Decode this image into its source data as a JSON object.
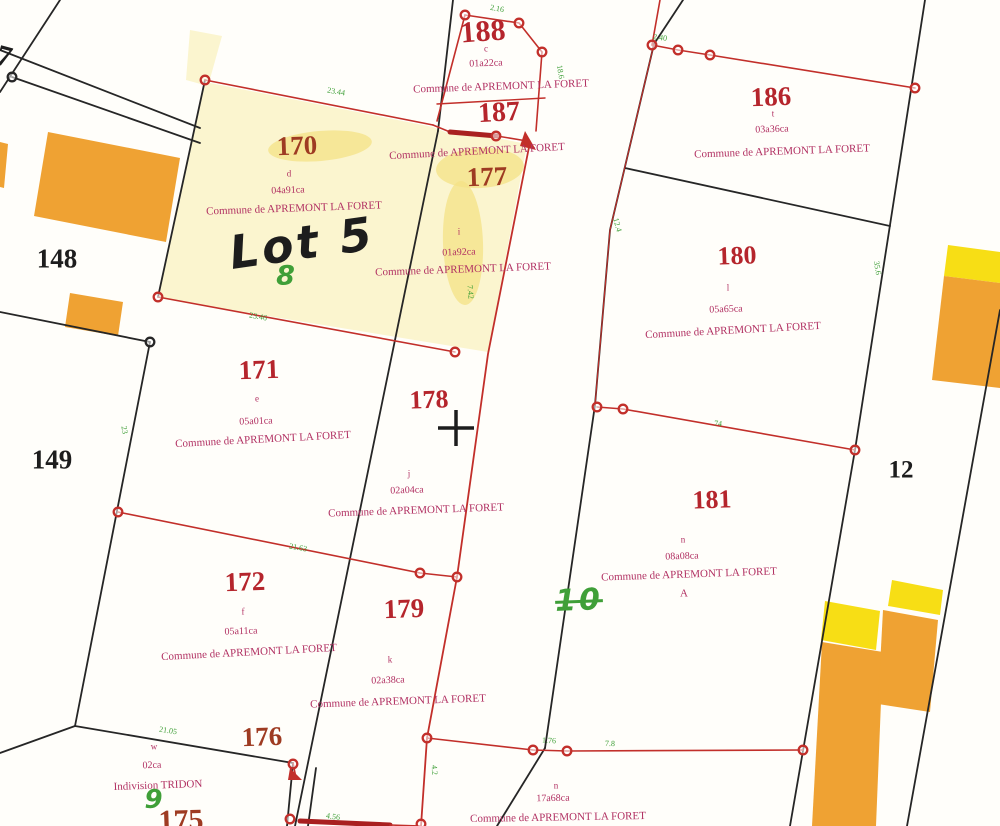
{
  "map": {
    "title": "Plan cadastral - Commune de APREMONT LA FORET",
    "commune_label": "Commune de APREMONT LA FORET",
    "colors": {
      "black": "#1d1d1d",
      "line_black": "#262626",
      "line_red": "#c22f2a",
      "thick_red": "#a92020",
      "red": "#b5252c",
      "red2": "#9e3b22",
      "magenta": "#b13062",
      "green": "#3f9f38",
      "cream": "#fbf5cf",
      "blob": "#f4e286",
      "orange": "#efa233",
      "yellow": "#f7de15",
      "white": "#ffffff"
    },
    "highlights": [
      {
        "name": "parcel-170-177-highlight",
        "points": "205,82 433,127 450,134 497,138 527,144 488,352 158,298",
        "fill": "cream"
      },
      {
        "name": "corner-highlight",
        "points": "190,30 222,36 208,86 186,80",
        "fill": "cream"
      }
    ],
    "blobs": [
      {
        "name": "highlight-blob",
        "cx": 320,
        "cy": 146,
        "rx": 52,
        "ry": 15,
        "rot": -5
      },
      {
        "name": "highlight-blob",
        "cx": 480,
        "cy": 168,
        "rx": 44,
        "ry": 20,
        "rot": -3
      },
      {
        "name": "highlight-blob",
        "cx": 463,
        "cy": 243,
        "rx": 20,
        "ry": 62,
        "rot": -2
      }
    ],
    "buildings": [
      {
        "name": "building-orange",
        "points": "48,132 180,158 166,242 34,216",
        "fill": "orange"
      },
      {
        "name": "building-orange",
        "points": "70,293 123,302 118,336 65,327",
        "fill": "orange"
      },
      {
        "name": "building-orange",
        "points": "0,142 8,144 4,188 0,187",
        "fill": "orange"
      },
      {
        "name": "building-yellow",
        "points": "948,245 1000,252 1000,283 944,276",
        "fill": "yellow"
      },
      {
        "name": "building-orange",
        "points": "944,276 1000,283 1000,388 932,380",
        "fill": "orange"
      },
      {
        "name": "building-yellow",
        "points": "825,601 880,611 876,650 821,640",
        "fill": "yellow"
      },
      {
        "name": "building-yellow",
        "points": "892,580 943,590 940,615 888,606",
        "fill": "yellow"
      },
      {
        "name": "building-orange",
        "points": "822,642 883,652 876,826 812,826",
        "fill": "orange"
      },
      {
        "name": "building-orange",
        "points": "883,610 938,620 930,712 878,704",
        "fill": "orange"
      }
    ],
    "black_lines": [
      {
        "p": "0,92 60,0"
      },
      {
        "p": "0,50 200,128"
      },
      {
        "p": "12,77 200,143"
      },
      {
        "p": "205,80 158,297"
      },
      {
        "p": "0,312 150,342"
      },
      {
        "p": "150,342 75,726"
      },
      {
        "p": "0,753 75,726"
      },
      {
        "p": "75,726 293,763"
      },
      {
        "p": "293,763 287,826"
      },
      {
        "p": "316,768 308,826"
      },
      {
        "p": "453,0 438,131"
      },
      {
        "p": "438,131 295,826"
      },
      {
        "p": "683,0 654,44"
      },
      {
        "p": "654,44 610,230 595,405"
      },
      {
        "p": "595,405 545,748"
      },
      {
        "p": "545,748 497,826"
      },
      {
        "p": "925,0 855,450"
      },
      {
        "p": "855,450 790,826"
      },
      {
        "p": "1000,310 907,826"
      },
      {
        "p": "625,168 890,226"
      }
    ],
    "red_lines": [
      {
        "p": "205,80 433,125",
        "w": 1.6
      },
      {
        "p": "433,125 450,132",
        "w": 1.6
      },
      {
        "p": "450,132 497,136",
        "w": 5
      },
      {
        "p": "497,136 527,141",
        "w": 1.6
      },
      {
        "p": "465,15 519,23 542,52",
        "w": 1.6
      },
      {
        "p": "542,52 536,131",
        "w": 1.6
      },
      {
        "p": "465,15 437,121",
        "w": 1.6
      },
      {
        "p": "437,104 545,98",
        "w": 1.4
      },
      {
        "p": "530,142 488,354 457,577 427,738 421,826",
        "w": 1.8
      },
      {
        "p": "158,297 455,352",
        "w": 1.6
      },
      {
        "p": "118,512 420,573 457,577",
        "w": 1.6
      },
      {
        "p": "597,407 623,409 855,450",
        "w": 1.6
      },
      {
        "p": "427,738 533,750 567,751 803,750",
        "w": 1.6
      },
      {
        "p": "652,45 660,0",
        "w": 1.6
      },
      {
        "p": "652,45 678,50 710,55 915,88",
        "w": 1.6
      },
      {
        "p": "654,44 610,230 595,405",
        "w": 1.1
      },
      {
        "p": "300,821 390,825",
        "w": 5
      },
      {
        "p": "390,825 421,826",
        "w": 1.6
      },
      {
        "p": "293,763 296,778",
        "w": 1.6
      }
    ],
    "vertices": [
      {
        "x": 205,
        "y": 80,
        "c": "red"
      },
      {
        "x": 158,
        "y": 297,
        "c": "red"
      },
      {
        "x": 455,
        "y": 352,
        "c": "red"
      },
      {
        "x": 465,
        "y": 15,
        "c": "red"
      },
      {
        "x": 519,
        "y": 23,
        "c": "red"
      },
      {
        "x": 542,
        "y": 52,
        "c": "red"
      },
      {
        "x": 496,
        "y": 136,
        "c": "red"
      },
      {
        "x": 652,
        "y": 45,
        "c": "red"
      },
      {
        "x": 678,
        "y": 50,
        "c": "red"
      },
      {
        "x": 710,
        "y": 55,
        "c": "red"
      },
      {
        "x": 915,
        "y": 88,
        "c": "red"
      },
      {
        "x": 597,
        "y": 407,
        "c": "red"
      },
      {
        "x": 623,
        "y": 409,
        "c": "red"
      },
      {
        "x": 855,
        "y": 450,
        "c": "red"
      },
      {
        "x": 118,
        "y": 512,
        "c": "red"
      },
      {
        "x": 420,
        "y": 573,
        "c": "red"
      },
      {
        "x": 457,
        "y": 577,
        "c": "red"
      },
      {
        "x": 427,
        "y": 738,
        "c": "red"
      },
      {
        "x": 533,
        "y": 750,
        "c": "red"
      },
      {
        "x": 567,
        "y": 751,
        "c": "red"
      },
      {
        "x": 803,
        "y": 750,
        "c": "red"
      },
      {
        "x": 290,
        "y": 819,
        "c": "red"
      },
      {
        "x": 421,
        "y": 824,
        "c": "red"
      },
      {
        "x": 293,
        "y": 764,
        "c": "red"
      },
      {
        "x": 12,
        "y": 77,
        "c": "black"
      },
      {
        "x": 150,
        "y": 342,
        "c": "black"
      }
    ],
    "spikes": [
      {
        "points": "525,131 536,150 520,146"
      },
      {
        "points": "290,768 302,780 288,780"
      }
    ],
    "cross": {
      "x": 456,
      "y": 428,
      "len": 18,
      "w": 3.5
    }
  },
  "labels": [
    {
      "text": "7",
      "x": 4,
      "y": 57,
      "s": 30,
      "c": "black",
      "r": 15,
      "name": "parcel-number-7"
    },
    {
      "text": "148",
      "x": 57,
      "y": 259,
      "s": 27,
      "c": "black",
      "r": 0,
      "name": "parcel-number-148"
    },
    {
      "text": "149",
      "x": 52,
      "y": 460,
      "s": 27,
      "c": "black",
      "r": 0,
      "name": "parcel-number-149"
    },
    {
      "text": "12",
      "x": 901,
      "y": 470,
      "s": 25,
      "c": "black",
      "r": 0,
      "name": "parcel-number-12"
    },
    {
      "text": "188",
      "x": 483,
      "y": 32,
      "s": 30,
      "c": "red",
      "r": -4,
      "name": "parcel-number-188"
    },
    {
      "text": "c",
      "x": 486,
      "y": 49,
      "s": 9,
      "c": "magenta",
      "r": 0,
      "name": "letter-label"
    },
    {
      "text": "01a22ca",
      "x": 486,
      "y": 64,
      "s": 10,
      "c": "magenta",
      "r": -2,
      "name": "area-label"
    },
    {
      "text": "Commune de APREMONT LA FORET",
      "x": 501,
      "y": 87,
      "s": 11,
      "c": "magenta",
      "r": -2,
      "name": "commune-label"
    },
    {
      "text": "187",
      "x": 499,
      "y": 113,
      "s": 28,
      "c": "red",
      "r": -3,
      "name": "parcel-number-187"
    },
    {
      "text": "Commune de APREMONT LA FORET",
      "x": 477,
      "y": 152,
      "s": 11,
      "c": "magenta",
      "r": -3,
      "name": "commune-label"
    },
    {
      "text": "177",
      "x": 487,
      "y": 177,
      "s": 27,
      "c": "red2",
      "r": -2,
      "name": "parcel-number-177"
    },
    {
      "text": "i",
      "x": 459,
      "y": 232,
      "s": 9,
      "c": "magenta",
      "r": 0,
      "name": "letter-label"
    },
    {
      "text": "01a92ca",
      "x": 459,
      "y": 253,
      "s": 10,
      "c": "magenta",
      "r": -2,
      "name": "area-label"
    },
    {
      "text": "Commune de APREMONT LA FORET",
      "x": 463,
      "y": 270,
      "s": 11,
      "c": "magenta",
      "r": -2,
      "name": "commune-label"
    },
    {
      "text": "186",
      "x": 771,
      "y": 97,
      "s": 27,
      "c": "red",
      "r": -2,
      "name": "parcel-number-186"
    },
    {
      "text": "t",
      "x": 773,
      "y": 114,
      "s": 9,
      "c": "magenta",
      "r": 0,
      "name": "letter-label"
    },
    {
      "text": "03a36ca",
      "x": 772,
      "y": 130,
      "s": 10,
      "c": "magenta",
      "r": -2,
      "name": "area-label"
    },
    {
      "text": "Commune de APREMONT LA FORET",
      "x": 782,
      "y": 152,
      "s": 11,
      "c": "magenta",
      "r": -2,
      "name": "commune-label"
    },
    {
      "text": "170",
      "x": 297,
      "y": 146,
      "s": 27,
      "c": "red2",
      "r": -2,
      "name": "parcel-number-170"
    },
    {
      "text": "d",
      "x": 289,
      "y": 174,
      "s": 9,
      "c": "magenta",
      "r": 0,
      "name": "letter-label"
    },
    {
      "text": "04a91ca",
      "x": 288,
      "y": 191,
      "s": 10,
      "c": "magenta",
      "r": -2,
      "name": "area-label"
    },
    {
      "text": "Commune de APREMONT LA FORET",
      "x": 294,
      "y": 209,
      "s": 11,
      "c": "magenta",
      "r": -2,
      "name": "commune-label"
    },
    {
      "text": "Lot 5",
      "x": 302,
      "y": 243,
      "s": 46,
      "c": "black",
      "r": -8,
      "name": "lot-annotation",
      "hand": true
    },
    {
      "text": "8",
      "x": 287,
      "y": 276,
      "s": 27,
      "c": "green",
      "r": 0,
      "name": "green-annotation-8",
      "hand": true
    },
    {
      "text": "180",
      "x": 737,
      "y": 256,
      "s": 26,
      "c": "red",
      "r": -2,
      "name": "parcel-number-180"
    },
    {
      "text": "l",
      "x": 728,
      "y": 288,
      "s": 9,
      "c": "magenta",
      "r": 0,
      "name": "letter-label"
    },
    {
      "text": "05a65ca",
      "x": 726,
      "y": 310,
      "s": 10,
      "c": "magenta",
      "r": -2,
      "name": "area-label"
    },
    {
      "text": "Commune de APREMONT LA FORET",
      "x": 733,
      "y": 331,
      "s": 11,
      "c": "magenta",
      "r": -3,
      "name": "commune-label"
    },
    {
      "text": "171",
      "x": 259,
      "y": 370,
      "s": 27,
      "c": "red",
      "r": -2,
      "name": "parcel-number-171"
    },
    {
      "text": "e",
      "x": 257,
      "y": 399,
      "s": 9,
      "c": "magenta",
      "r": 0,
      "name": "letter-label"
    },
    {
      "text": "05a01ca",
      "x": 256,
      "y": 422,
      "s": 10,
      "c": "magenta",
      "r": -2,
      "name": "area-label"
    },
    {
      "text": "Commune de APREMONT LA FORET",
      "x": 263,
      "y": 440,
      "s": 11,
      "c": "magenta",
      "r": -3,
      "name": "commune-label"
    },
    {
      "text": "178",
      "x": 429,
      "y": 400,
      "s": 26,
      "c": "red",
      "r": -2,
      "name": "parcel-number-178"
    },
    {
      "text": "j",
      "x": 409,
      "y": 474,
      "s": 9,
      "c": "magenta",
      "r": 0,
      "name": "letter-label"
    },
    {
      "text": "02a04ca",
      "x": 407,
      "y": 491,
      "s": 10,
      "c": "magenta",
      "r": -2,
      "name": "area-label"
    },
    {
      "text": "Commune de APREMONT LA FORET",
      "x": 416,
      "y": 511,
      "s": 11,
      "c": "magenta",
      "r": -2,
      "name": "commune-label"
    },
    {
      "text": "181",
      "x": 712,
      "y": 500,
      "s": 26,
      "c": "red",
      "r": -2,
      "name": "parcel-number-181"
    },
    {
      "text": "n",
      "x": 683,
      "y": 540,
      "s": 9,
      "c": "magenta",
      "r": 0,
      "name": "letter-label"
    },
    {
      "text": "08a08ca",
      "x": 682,
      "y": 557,
      "s": 10,
      "c": "magenta",
      "r": -2,
      "name": "area-label"
    },
    {
      "text": "Commune de APREMONT LA FORET",
      "x": 689,
      "y": 575,
      "s": 11,
      "c": "magenta",
      "r": -2,
      "name": "commune-label"
    },
    {
      "text": "A",
      "x": 684,
      "y": 594,
      "s": 11,
      "c": "magenta",
      "r": 0,
      "name": "letter-label"
    },
    {
      "text": "10",
      "x": 579,
      "y": 601,
      "s": 30,
      "c": "green",
      "r": -2,
      "name": "green-annotation-10",
      "hand": true,
      "strike": true
    },
    {
      "text": "172",
      "x": 245,
      "y": 582,
      "s": 27,
      "c": "red",
      "r": -2,
      "name": "parcel-number-172"
    },
    {
      "text": "f",
      "x": 243,
      "y": 612,
      "s": 9,
      "c": "magenta",
      "r": 0,
      "name": "letter-label"
    },
    {
      "text": "05a11ca",
      "x": 241,
      "y": 632,
      "s": 10,
      "c": "magenta",
      "r": -2,
      "name": "area-label"
    },
    {
      "text": "Commune de APREMONT LA FORET",
      "x": 249,
      "y": 653,
      "s": 11,
      "c": "magenta",
      "r": -3,
      "name": "commune-label"
    },
    {
      "text": "179",
      "x": 404,
      "y": 609,
      "s": 27,
      "c": "red",
      "r": -2,
      "name": "parcel-number-179"
    },
    {
      "text": "k",
      "x": 390,
      "y": 660,
      "s": 9,
      "c": "magenta",
      "r": 0,
      "name": "letter-label"
    },
    {
      "text": "02a38ca",
      "x": 388,
      "y": 681,
      "s": 10,
      "c": "magenta",
      "r": -2,
      "name": "area-label"
    },
    {
      "text": "Commune de APREMONT LA FORET",
      "x": 398,
      "y": 702,
      "s": 11,
      "c": "magenta",
      "r": -2,
      "name": "commune-label"
    },
    {
      "text": "176",
      "x": 262,
      "y": 737,
      "s": 27,
      "c": "red2",
      "r": -2,
      "name": "parcel-number-176"
    },
    {
      "text": "w",
      "x": 154,
      "y": 747,
      "s": 9,
      "c": "magenta",
      "r": 0,
      "name": "letter-label"
    },
    {
      "text": "02ca",
      "x": 152,
      "y": 766,
      "s": 10,
      "c": "magenta",
      "r": -2,
      "name": "area-label"
    },
    {
      "text": "Indivision TRIDON",
      "x": 158,
      "y": 786,
      "s": 11,
      "c": "magenta",
      "r": -2,
      "name": "owner-label"
    },
    {
      "text": "9",
      "x": 155,
      "y": 800,
      "s": 26,
      "c": "green",
      "r": 0,
      "name": "green-annotation-9",
      "hand": true
    },
    {
      "text": "175",
      "x": 181,
      "y": 821,
      "s": 30,
      "c": "red2",
      "r": -2,
      "name": "parcel-number-175"
    },
    {
      "text": "n",
      "x": 556,
      "y": 786,
      "s": 9,
      "c": "magenta",
      "r": 0,
      "name": "letter-label"
    },
    {
      "text": "17a68ca",
      "x": 553,
      "y": 799,
      "s": 10,
      "c": "magenta",
      "r": -1,
      "name": "area-label"
    },
    {
      "text": "Commune de APREMONT LA FORET",
      "x": 558,
      "y": 818,
      "s": 11,
      "c": "magenta",
      "r": -1,
      "name": "commune-label"
    },
    {
      "text": "2.16",
      "x": 497,
      "y": 9,
      "s": 8,
      "c": "green",
      "r": 10,
      "name": "measurement-label"
    },
    {
      "text": "23.44",
      "x": 336,
      "y": 92,
      "s": 8,
      "c": "green",
      "r": 10,
      "name": "measurement-label"
    },
    {
      "text": "2.40",
      "x": 660,
      "y": 38,
      "s": 8,
      "c": "green",
      "r": 8,
      "name": "measurement-label"
    },
    {
      "text": "18.6",
      "x": 560,
      "y": 72,
      "s": 8,
      "c": "green",
      "r": 80,
      "name": "measurement-label"
    },
    {
      "text": "23.46",
      "x": 258,
      "y": 317,
      "s": 8,
      "c": "green",
      "r": 10,
      "name": "measurement-label"
    },
    {
      "text": "21.63",
      "x": 298,
      "y": 548,
      "s": 8,
      "c": "green",
      "r": 10,
      "name": "measurement-label"
    },
    {
      "text": "74",
      "x": 718,
      "y": 424,
      "s": 8,
      "c": "green",
      "r": 6,
      "name": "measurement-label"
    },
    {
      "text": "35.6",
      "x": 877,
      "y": 268,
      "s": 8,
      "c": "green",
      "r": 80,
      "name": "measurement-label"
    },
    {
      "text": "12.4",
      "x": 617,
      "y": 225,
      "s": 8,
      "c": "green",
      "r": 75,
      "name": "measurement-label"
    },
    {
      "text": "7.42",
      "x": 470,
      "y": 292,
      "s": 8,
      "c": "green",
      "r": 85,
      "name": "measurement-label"
    },
    {
      "text": "23",
      "x": 124,
      "y": 430,
      "s": 8,
      "c": "green",
      "r": 80,
      "name": "measurement-label"
    },
    {
      "text": "21.05",
      "x": 168,
      "y": 731,
      "s": 8,
      "c": "green",
      "r": 9,
      "name": "measurement-label"
    },
    {
      "text": "4.56",
      "x": 333,
      "y": 817,
      "s": 8,
      "c": "green",
      "r": 8,
      "name": "measurement-label"
    },
    {
      "text": "1.76",
      "x": 549,
      "y": 741,
      "s": 8,
      "c": "green",
      "r": 3,
      "name": "measurement-label"
    },
    {
      "text": "7.8",
      "x": 610,
      "y": 744,
      "s": 8,
      "c": "green",
      "r": 2,
      "name": "measurement-label"
    },
    {
      "text": "4.2",
      "x": 434,
      "y": 770,
      "s": 8,
      "c": "green",
      "r": 85,
      "name": "measurement-label"
    }
  ]
}
